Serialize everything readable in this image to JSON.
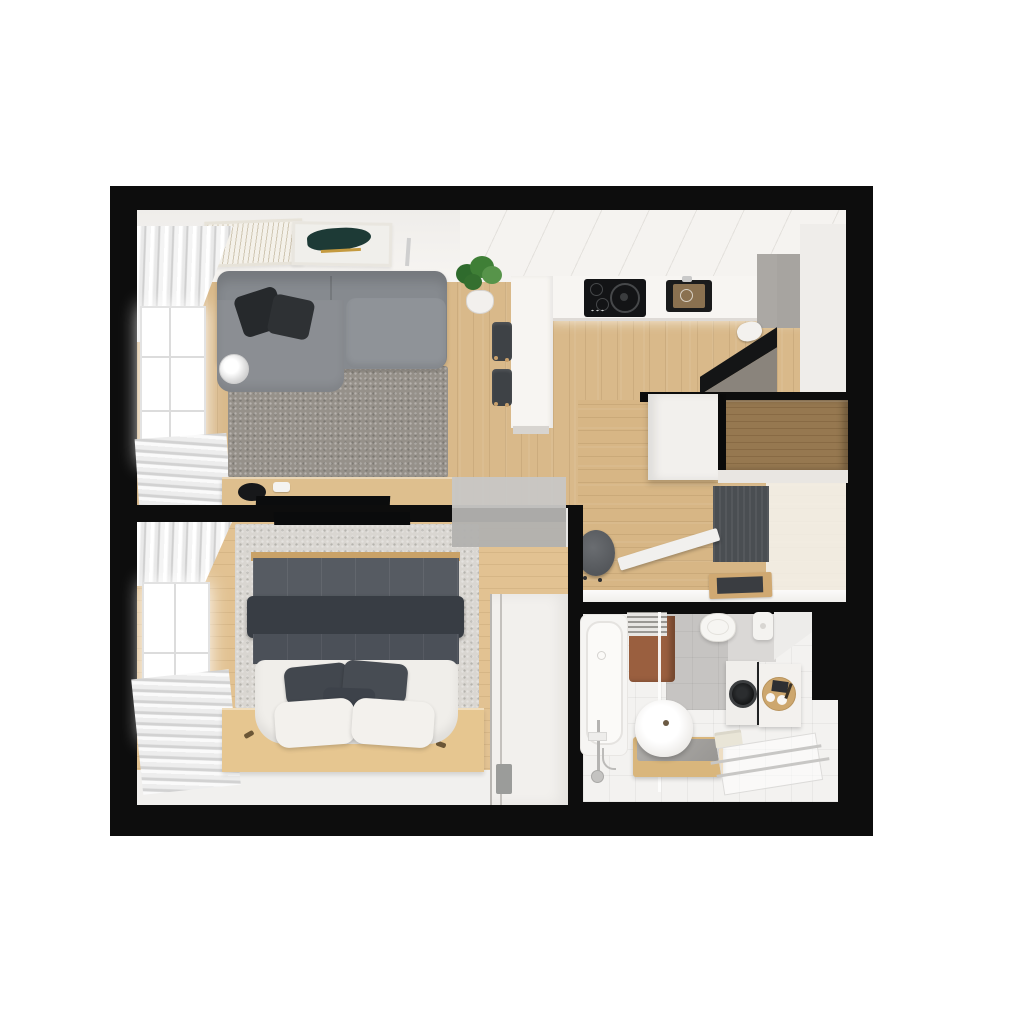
{
  "scene": {
    "type": "3d-floor-plan-render",
    "description": "Top-down 3D render of a one-bedroom apartment floor plan on a white background, thick black exterior walls",
    "background": "#ffffff"
  },
  "palette": {
    "wall": "#0d0d0d",
    "wood": "#d9b98a",
    "woodBedroom": "#e2c292",
    "woodHall": "#d7b685",
    "bathFloor": "#f3f2f0",
    "sofa": "#868a8f",
    "rugLiving": "#96918a",
    "rugBedroom": "#d9d6d1",
    "duvet": "#565b62",
    "duvetFold": "#383d44",
    "linen": "#f0eeea",
    "pillowDark": "#43484f",
    "counterWhite": "#f7f5f2",
    "cooktop": "#131416",
    "doorBrown": "#967850",
    "doormat": "#4a4e52",
    "frosted": "#c0bfbd",
    "towel": "#9a5f3f",
    "tile": "#c6c4c2",
    "chairDark": "#3e4246",
    "plantGreen": "#3f7f36",
    "trayWood": "#cda76e",
    "platformWood": "#e6c690",
    "consoleWood": "#debf8e"
  },
  "rooms": [
    {
      "name": "living-room",
      "furniture": [
        "sectional-sofa",
        "throw-pillows",
        "area-rug",
        "tv-console",
        "flat-tv",
        "decor-bowl",
        "wall-art-frame-sketch",
        "wall-art-frame-teal-blob",
        "curtains",
        "window",
        "lamp-side-table",
        "potted-plant"
      ]
    },
    {
      "name": "kitchen",
      "furniture": [
        "u-shaped-white-counter",
        "upper-cabinets",
        "cooktop",
        "sink",
        "tall-gray-cabinet",
        "corner-unit",
        "kettle",
        "bar-chair",
        "bar-chair"
      ]
    },
    {
      "name": "entrance-hall",
      "furniture": [
        "entrance-door-open",
        "hall-cabinet",
        "doormat",
        "shoe-tray",
        "round-stool",
        "open-white-door"
      ]
    },
    {
      "name": "bedroom",
      "furniture": [
        "double-bed",
        "duvet",
        "dark-pillows",
        "white-pillows",
        "bed-platform",
        "wardrobe",
        "area-rug",
        "curtains",
        "window",
        "wall-tv",
        "frosted-glass-door"
      ]
    },
    {
      "name": "bathroom",
      "furniture": [
        "bathtub",
        "shower-set",
        "vessel-sink-vanity",
        "toilet",
        "cistern",
        "washing-machine",
        "bath-cabinet",
        "toiletry-tray",
        "towel-radiator",
        "brown-towel",
        "floor-towel",
        "shower-drain-rails"
      ]
    }
  ]
}
